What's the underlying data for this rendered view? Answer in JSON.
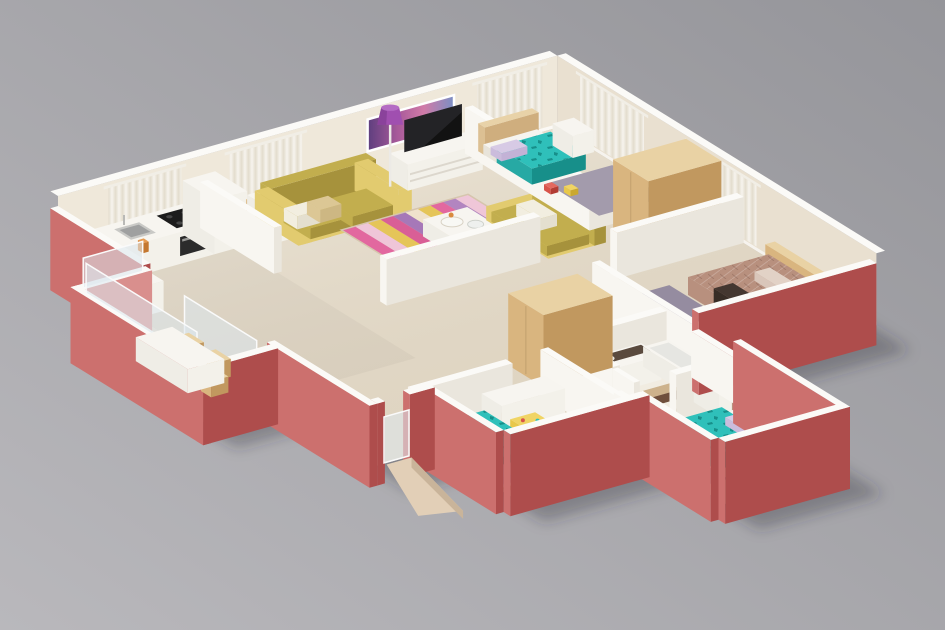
{
  "scene": {
    "type": "3d-floor-plan-render",
    "description": "Isometric 3D render of a three-bedroom apartment floor plan with pink exterior walls, cream interior walls, wood floors and furnished rooms on a gray studio background",
    "view": "isometric-overhead",
    "background": "studio gray gradient"
  },
  "colors": {
    "background_top": "#95959a",
    "background_bottom": "#b9b8bc",
    "floor": "#e9e1cf",
    "floor_tile": "#ded6c6",
    "floor_balcony": "#e4dac8",
    "wall_far": "#efe8da",
    "wall_far_side": "#e9e0d0",
    "wall_cap": "#fbfaf7",
    "wall_white_l": "#f8f6f1",
    "wall_white_r": "#eae6dd",
    "pink_light": "#cc706e",
    "pink_dark": "#ae4d4c",
    "pink_inner": "#d98f8d",
    "curtain_a": "#f7f4ee",
    "curtain_b": "#e3dccd",
    "art_1": "#5d3e7e",
    "art_2": "#a85a9a",
    "art_3": "#d17ba8",
    "art_4": "#7a8fc4",
    "sofa_main": "#c2ae4e",
    "sofa_dark": "#a6923c",
    "sofa_light": "#e2cb6f",
    "pillow_white": "#f2eee0",
    "pillow_tan": "#dcc795",
    "rug_stripes": [
      "#e2689f",
      "#efc6d8",
      "#e5c559",
      "#d95f96",
      "#a678b8",
      "#f0e2cc",
      "#e5c559",
      "#e2689f",
      "#b285c0",
      "#efc6d8"
    ],
    "white_l": "#efede6",
    "white_r": "#f3f1ea",
    "white_top": "#f7f5f0",
    "lamp_purple": "#a04fb0",
    "lamp_purple_dark": "#7c3a8e",
    "lamp_top": "#b46cc4",
    "tv_black": "#121212",
    "teal": "#2fc0ba",
    "teal_mid": "#27a9a4",
    "teal_dark": "#178f8a",
    "pillow_lavender": "#d7cae5",
    "mattress": "#f6f4ef",
    "headboard_tan": "#e5c89b",
    "wood_l": "#d9b57f",
    "wood_r": "#c1985f",
    "wood_top": "#e9d2a4",
    "master_spread": "#b8907e",
    "master_spread_dark": "#a37b6b",
    "master_pillow": "#d9c6ba",
    "master_throw": "#443730",
    "rug_gray": "#a39bac",
    "rug_gray_dark": "#958ca0",
    "bath_light": "#f1ece1",
    "bath_dark": "#6f4f3c",
    "bath_tan": "#cdb28c",
    "vanity_counter": "#5a4a3e",
    "ramp": "#e2cfb7",
    "ramp_side": "#c9b49a",
    "glass": "rgba(220,232,238,0.55)",
    "frame": "#fafafa",
    "steel": "#c9c9c6",
    "steel_dark": "#9fa0a0",
    "cooktop": "#1c1c1c",
    "shadow": "rgba(45,42,52,0.32)",
    "toy_red": "#d8544a",
    "toy_yellow": "#e8c84a",
    "deco_orange": "#d98a3e"
  },
  "rooms": [
    {
      "name": "Kitchen",
      "furniture": [
        "counter with cooktop and sink",
        "oven",
        "refrigerator",
        "low cabinet"
      ]
    },
    {
      "name": "Dining Area",
      "furniture": [
        "white dining table",
        "wooden chairs"
      ]
    },
    {
      "name": "Living Room",
      "furniture": [
        "yellow sofa",
        "yellow armchair",
        "striped pink-yellow rug",
        "white coffee table",
        "purple floor lamp",
        "TV console",
        "flat-screen TV",
        "purple wall art"
      ]
    },
    {
      "name": "Bedroom 1",
      "furniture": [
        "single bed with teal cover",
        "tan headboard",
        "nightstand drawers",
        "gray rug",
        "toys"
      ]
    },
    {
      "name": "Master Bedroom",
      "furniture": [
        "double bed with patterned spread",
        "tall wooden wardrobe",
        "gray rug",
        "dark throw"
      ]
    },
    {
      "name": "Bathroom",
      "furniture": [
        "vanity with dark counter",
        "bathtub",
        "striped tile floor",
        "door"
      ]
    },
    {
      "name": "Bedroom 2",
      "furniture": [
        "single bed with teal cover",
        "white desk",
        "yellow play table",
        "gray rug",
        "wooden wardrobe"
      ]
    },
    {
      "name": "Bedroom 3",
      "furniture": [
        "single bed with teal cover",
        "mauve headboard cushion",
        "white drawer unit",
        "gray rug"
      ]
    },
    {
      "name": "Balcony",
      "furniture": [
        "white outdoor table",
        "wooden chairs",
        "glass railing panels"
      ]
    },
    {
      "name": "Entry",
      "furniture": [
        "ramp walkway",
        "glass entry door"
      ]
    }
  ]
}
